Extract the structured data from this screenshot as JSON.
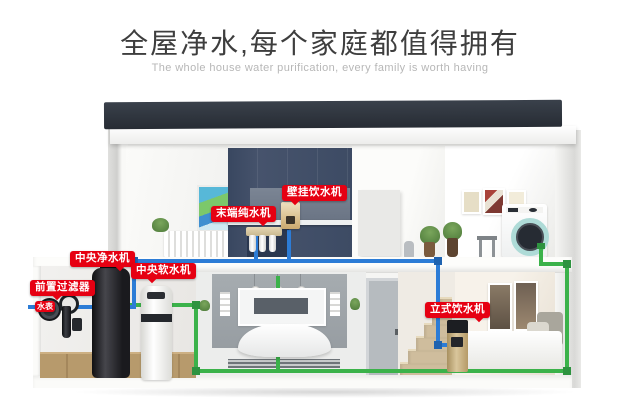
{
  "header": {
    "title": "全屋净水,每个家庭都值得拥有",
    "subtitle": "The whole house water purification, every family is worth having"
  },
  "labels": {
    "wall_dispenser": "壁挂饮水机",
    "terminal_purifier": "末端纯水机",
    "central_purifier": "中央净水机",
    "central_softener": "中央软水机",
    "pre_filter": "前置过滤器",
    "water_meter": "水表",
    "standing_dispenser": "立式饮水机"
  },
  "colors": {
    "label_red": "#e60012",
    "pipe_blue": "#2c7cd6",
    "pipe_green": "#3bb24a",
    "roof_dark": "#2e343d",
    "kitchen_navy": "#46536c"
  }
}
